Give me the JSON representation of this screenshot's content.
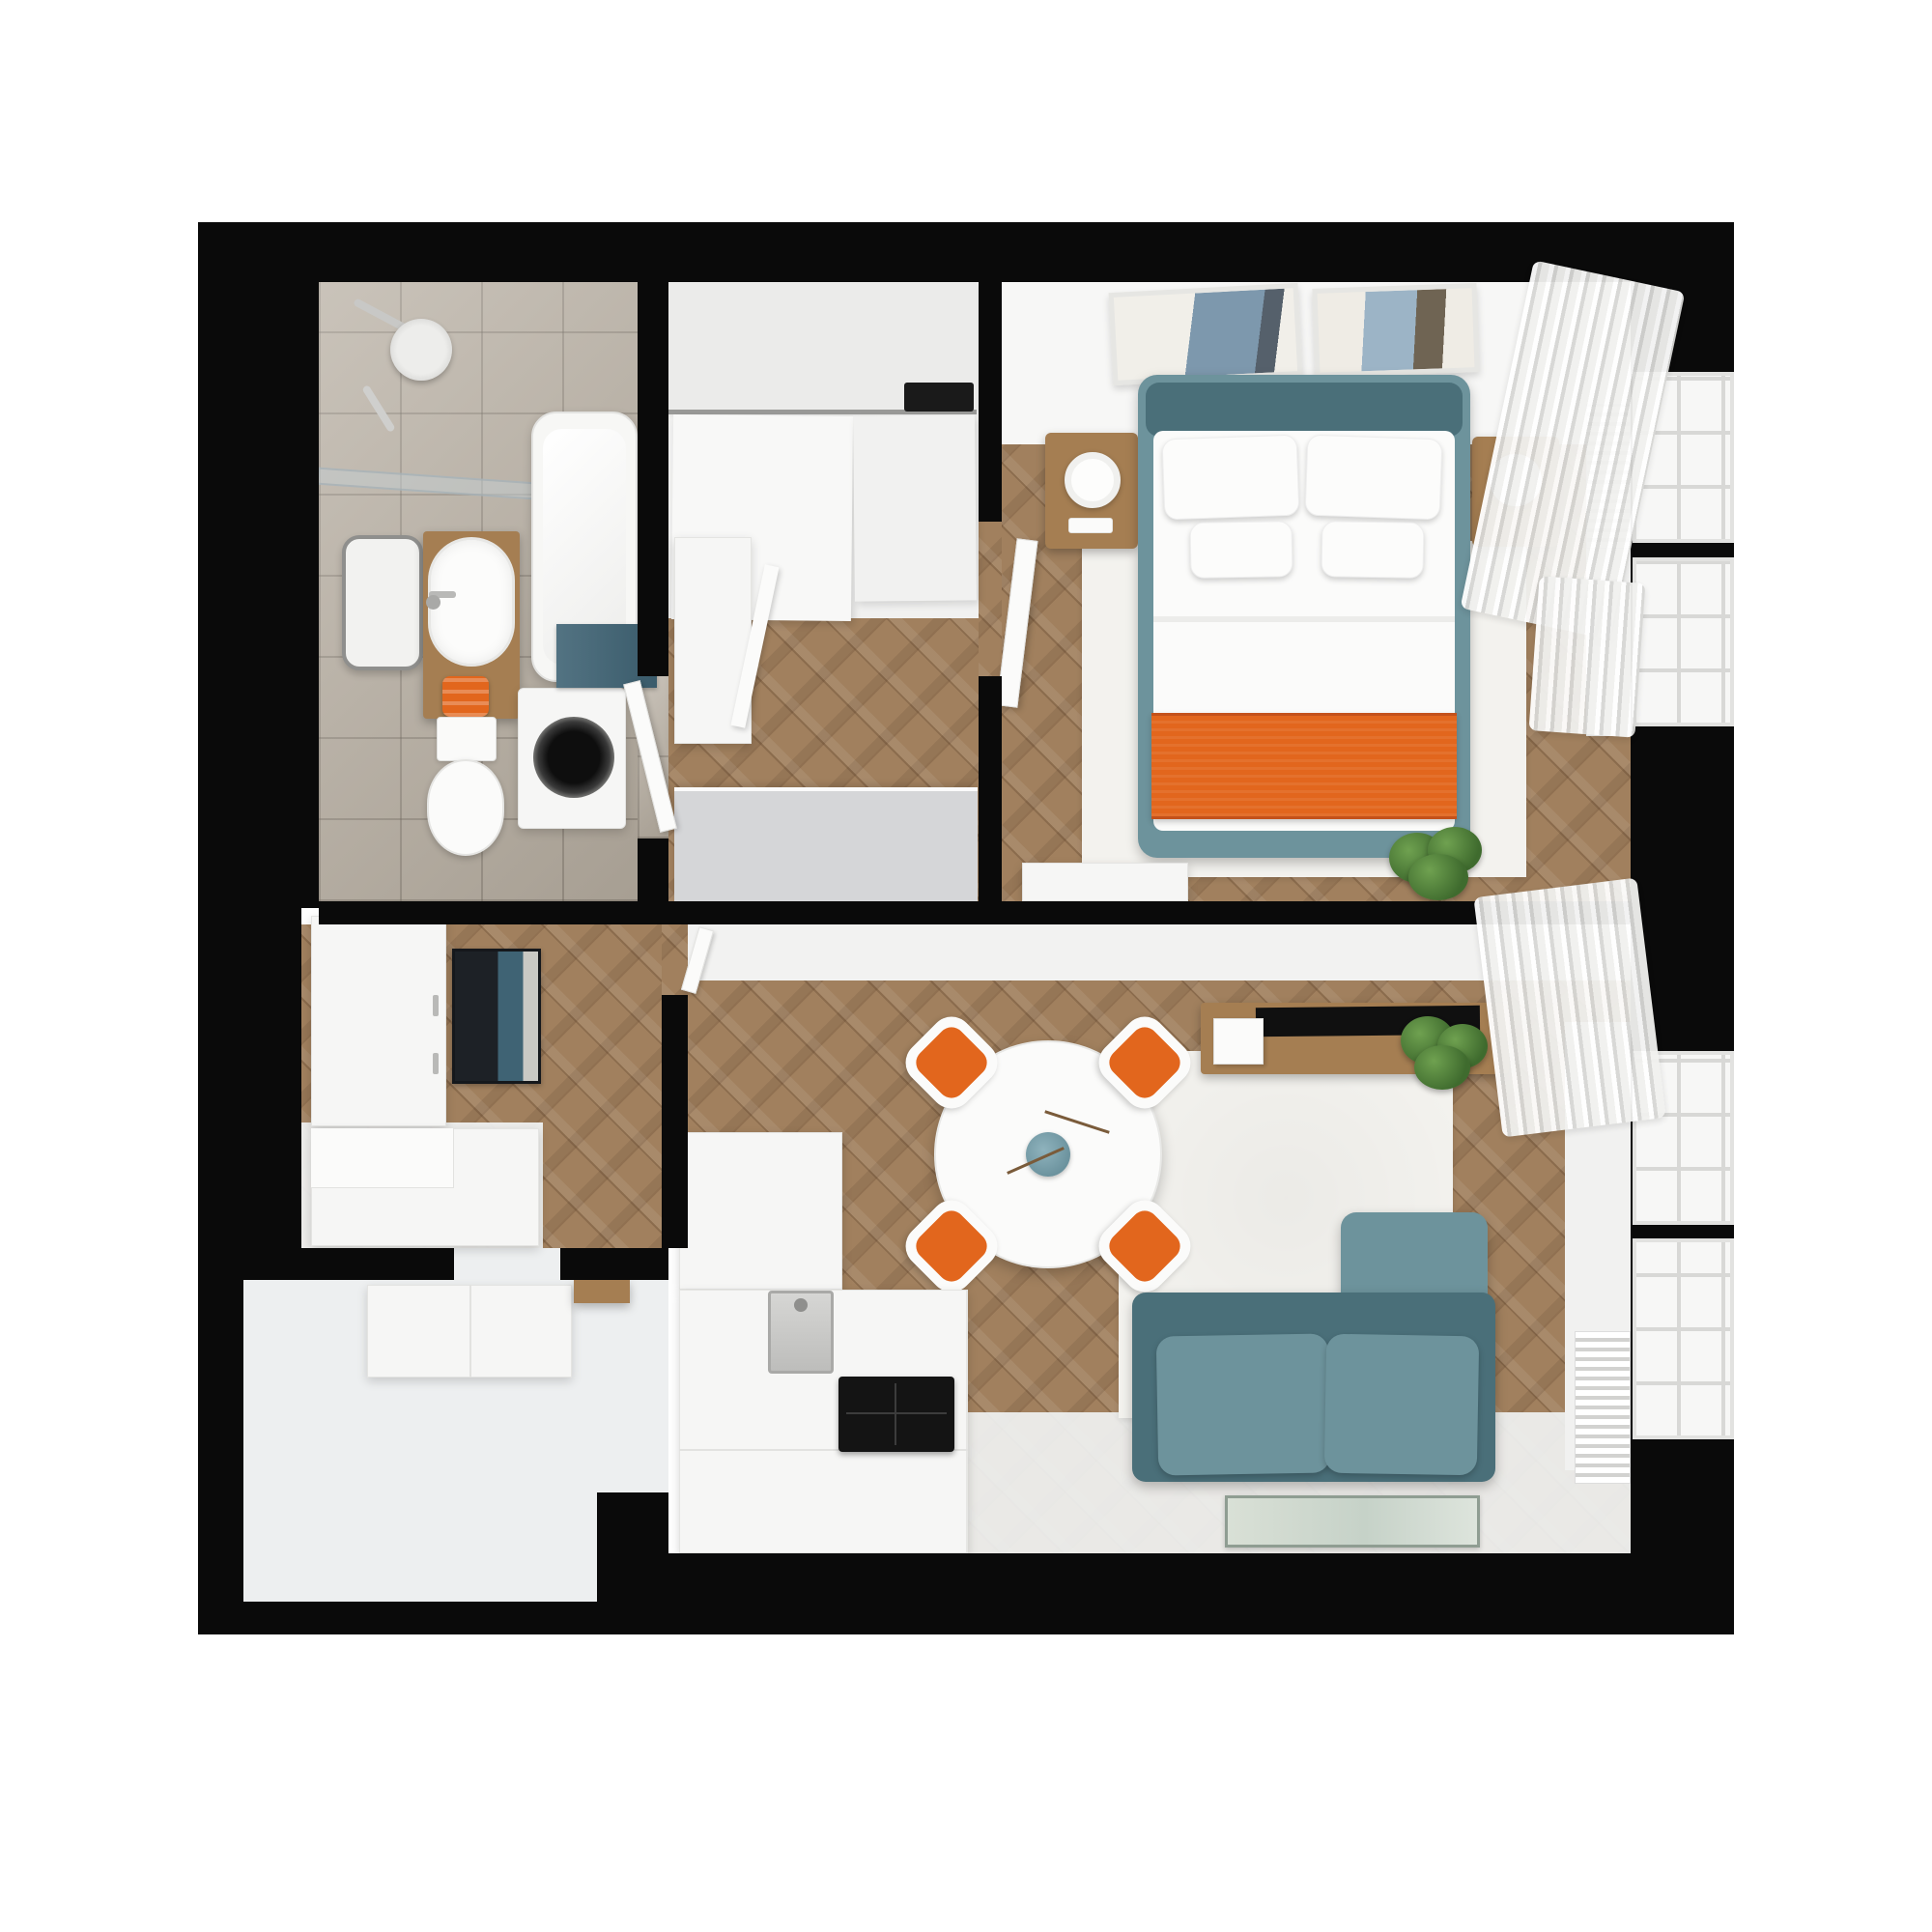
{
  "image": {
    "title": "Apartment floor plan — 3D top-down render",
    "style": "photoreal cutaway plan"
  },
  "palette": {
    "wall": "#0a0a0a",
    "background": "#ffffff",
    "wood": "#a1805e",
    "tile": "#b5ac9f",
    "white-furniture": "#f6f6f5",
    "wood-furniture": "#a57e52",
    "teal": "#6d939c",
    "teal-dark": "#4a6f79",
    "orange": "#e2661d",
    "entry-closet-gray": "#d5d6d8",
    "plant-green": "#55823f",
    "mat-black": "#1d2126",
    "mat-teal": "#3f6374",
    "rug-white": "#f3f2ee"
  },
  "rooms": [
    {
      "id": "bathroom",
      "name": "bathroom",
      "floor": "gray-tile",
      "items": [
        "shower-head",
        "shower-glass-screen",
        "bathtub",
        "wall-mirror",
        "wood-vanity",
        "oval-sink",
        "orange-towels",
        "toilet",
        "washing-machine",
        "teal-bath-mat"
      ]
    },
    {
      "id": "dressing-hall",
      "name": "dressing-hall",
      "floor": "herringbone-wood",
      "items": [
        "sliding-door-wardrobe",
        "sliding-rail",
        "door-mechanism",
        "open-wardrobe-cabinet",
        "entry-closet"
      ]
    },
    {
      "id": "bedroom",
      "name": "bedroom",
      "floor": "herringbone-wood",
      "items": [
        "double-bed-teal-frame",
        "white-duvet",
        "orange-blanket",
        "pillows-x4",
        "nightstand-left",
        "nightstand-right",
        "bedside-lamps",
        "wall-art-x2",
        "white-area-rug",
        "white-dresser",
        "potted-plant",
        "open-door",
        "windows-x2",
        "curtains",
        "window-ledge"
      ]
    },
    {
      "id": "living-kitchen",
      "name": "living-kitchen",
      "floor": "herringbone-wood-and-white",
      "items": [
        "round-dining-table",
        "teal-vase-with-branch",
        "orange-chairs-x4",
        "teal-sofa",
        "white-area-rug",
        "tv-console",
        "tv-flat",
        "magazines",
        "potted-plant",
        "kitchen-tall-cabinet",
        "kitchen-counter",
        "steel-sink",
        "black-cooktop",
        "floor-lamp",
        "framed-floor-mat",
        "radiator",
        "windows-x2",
        "curtains"
      ]
    },
    {
      "id": "entry-hall",
      "name": "entry-hall",
      "floor": "herringbone-wood",
      "items": [
        "white-wardrobe-cabinet",
        "striped-doormat",
        "white-bench"
      ]
    },
    {
      "id": "storage-room",
      "name": "storage-room",
      "floor": "white",
      "items": [
        "white-cabinet",
        "wood-door-frame"
      ]
    }
  ],
  "counts": {
    "windows": 4,
    "dining_chairs": 4,
    "bed_pillows": 4,
    "rooms": 6
  }
}
